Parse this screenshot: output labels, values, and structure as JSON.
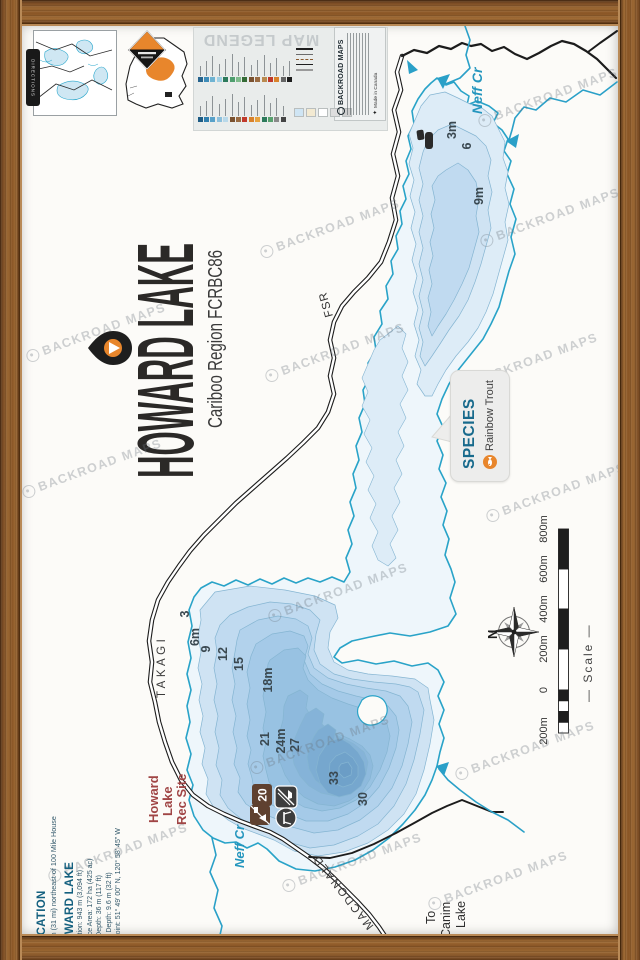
{
  "brand": {
    "name": "BACKROAD MAPS",
    "made_in": "Made in Canada",
    "tab": "DIRECTIONS"
  },
  "title": {
    "main": "HOWARD LAKE",
    "subtitle": "Cariboo Region FCRBC86"
  },
  "legend": {
    "title": "MAP LEGEND",
    "band1_colors": [
      "#26648e",
      "#3e8cb8",
      "#6fb3d2",
      "#9fd0e4",
      "#2c7a5b",
      "#4f9e6e",
      "#7fbb8c",
      "#356b36",
      "#7a5230",
      "#9a6b42",
      "#b98a4f",
      "#c0392b",
      "#d9822b",
      "#666666",
      "#1d1d1d"
    ],
    "band2_colors": [
      "#1d5c85",
      "#2f7fae",
      "#58a1c9",
      "#8cc0dc",
      "#b9d9ea",
      "#7a5230",
      "#9a6b42",
      "#c0392b",
      "#d9822b",
      "#e8a33f",
      "#2c7a5b",
      "#58a16e",
      "#8a8a8a",
      "#444444"
    ],
    "line_samples": [
      "#1e1e1e",
      "#6b6b6b",
      "#8a5a2e",
      "#1e1e1e",
      "#9a9a9a"
    ],
    "area_samples": [
      "#cfe5f4",
      "#f3ead2",
      "#ffffff",
      "#dedede",
      "#cfcfcf"
    ]
  },
  "species": {
    "heading": "SPECIES",
    "value": "Rainbow Trout"
  },
  "labels": {
    "neff_cr_north": "Neff Cr",
    "neff_cr_south": "Neff Cr",
    "fsr": "FSR",
    "takagi": "TAKAGI",
    "macdonald": "MACDONALD",
    "to_canim": [
      "To",
      "Canim",
      "Lake"
    ],
    "north": "N",
    "scale_caption": "—  Scale  —"
  },
  "rec_site": {
    "name_lines": [
      "Howard",
      "Lake",
      "Rec Site"
    ],
    "campsites": "20"
  },
  "depth_labels": {
    "upper": [
      [
        "3m",
        456,
        130
      ],
      [
        "6",
        471,
        146
      ],
      [
        "9m",
        483,
        196
      ]
    ],
    "lower": [
      [
        "3",
        189,
        614
      ],
      [
        "6m",
        199,
        637
      ],
      [
        "9",
        210,
        649
      ],
      [
        "12",
        227,
        654
      ],
      [
        "15",
        243,
        664
      ],
      [
        "18m",
        272,
        680
      ],
      [
        "21",
        269,
        739
      ],
      [
        "24m",
        285,
        741
      ],
      [
        "27",
        299,
        745
      ],
      [
        "33",
        338,
        778
      ],
      [
        "30",
        367,
        799
      ]
    ]
  },
  "scale_bar": {
    "labels": [
      [
        "800m",
        529
      ],
      [
        "600m",
        569
      ],
      [
        "400m",
        609
      ],
      [
        "200m",
        649
      ],
      [
        "0",
        690
      ],
      [
        "200m",
        731
      ]
    ]
  },
  "info": {
    "location_heading": "LOCATION",
    "location_text": "50 km (31 mi) northeast of 100 Mile House",
    "lake_heading": "HOWARD LAKE",
    "stats": [
      "Elevation: 943 m (3,094 ft)",
      "Surface Area: 172 ha (425 ac)",
      "Max Depth: 36 m (117 ft)",
      "Mean Depth: 9.6 m (32 ft)",
      "Waypoint: 51° 49' 00\" N, 120° 58' 45\" W"
    ]
  },
  "watermark": {
    "text": "BACKROAD MAPS",
    "positions": [
      [
        548,
        97
      ],
      [
        550,
        217
      ],
      [
        330,
        228
      ],
      [
        96,
        332
      ],
      [
        335,
        352
      ],
      [
        528,
        362
      ],
      [
        92,
        468
      ],
      [
        556,
        492
      ],
      [
        338,
        592
      ],
      [
        320,
        744
      ],
      [
        525,
        750
      ],
      [
        352,
        862
      ],
      [
        118,
        852
      ],
      [
        498,
        880
      ]
    ]
  },
  "colors": {
    "accent_orange": "#e8862c",
    "water_line": "#29a3c8",
    "wood": "#8b5a2e",
    "species_heading": "#186a8c",
    "rec_red": "#a04545",
    "info_teal": "#14607f"
  }
}
